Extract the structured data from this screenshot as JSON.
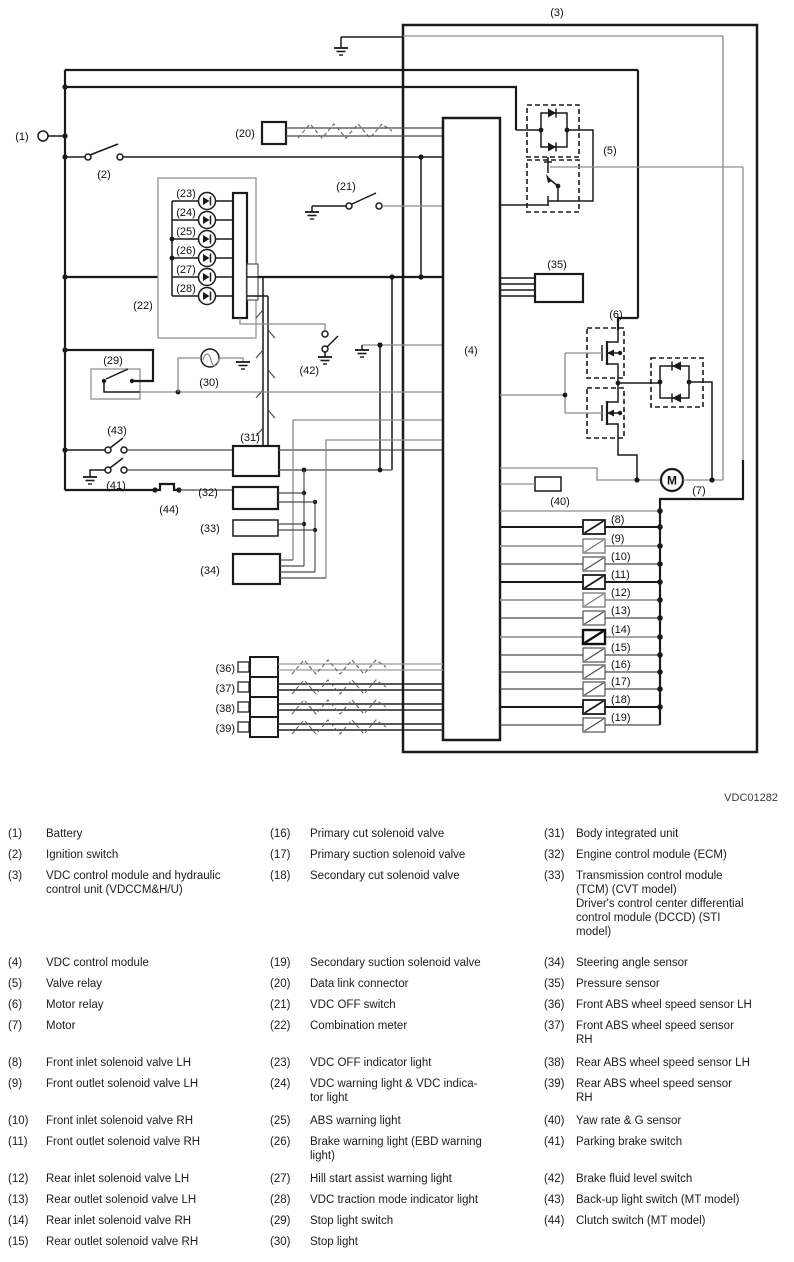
{
  "figure": {
    "code": "VDC01282"
  },
  "colors": {
    "wire": "#1a1a1a",
    "thin": "#4a4a4a",
    "gray": "#8c8c8c",
    "background": "#ffffff"
  },
  "diagram": {
    "callouts": [
      {
        "t": "(1)",
        "x": 22,
        "y": 140
      },
      {
        "t": "(2)",
        "x": 104,
        "y": 178
      },
      {
        "t": "(3)",
        "x": 557,
        "y": 16
      },
      {
        "t": "(4)",
        "x": 471,
        "y": 354
      },
      {
        "t": "(5)",
        "x": 610,
        "y": 154
      },
      {
        "t": "(6)",
        "x": 616,
        "y": 318
      },
      {
        "t": "(7)",
        "x": 699,
        "y": 494
      },
      {
        "t": "(20)",
        "x": 245,
        "y": 137
      },
      {
        "t": "(21)",
        "x": 346,
        "y": 190
      },
      {
        "t": "(22)",
        "x": 143,
        "y": 309
      },
      {
        "t": "(29)",
        "x": 113,
        "y": 364
      },
      {
        "t": "(30)",
        "x": 209,
        "y": 386
      },
      {
        "t": "(31)",
        "x": 250,
        "y": 441
      },
      {
        "t": "(32)",
        "x": 208,
        "y": 496
      },
      {
        "t": "(33)",
        "x": 210,
        "y": 532
      },
      {
        "t": "(34)",
        "x": 210,
        "y": 574
      },
      {
        "t": "(35)",
        "x": 557,
        "y": 268
      },
      {
        "t": "(40)",
        "x": 560,
        "y": 505
      },
      {
        "t": "(41)",
        "x": 116,
        "y": 489
      },
      {
        "t": "(42)",
        "x": 319,
        "y": 374,
        "a": "end"
      },
      {
        "t": "(43)",
        "x": 117,
        "y": 434
      },
      {
        "t": "(44)",
        "x": 169,
        "y": 513
      }
    ],
    "led_rows": {
      "labels": [
        "(23)",
        "(24)",
        "(25)",
        "(26)",
        "(27)",
        "(28)"
      ],
      "ys": [
        201,
        220,
        239,
        258,
        277,
        296
      ]
    },
    "solenoid_rows": {
      "labels": [
        "(8)",
        "(9)",
        "(10)",
        "(11)",
        "(12)",
        "(13)",
        "(14)",
        "(15)",
        "(16)",
        "(17)",
        "(18)",
        "(19)"
      ],
      "ys": [
        527,
        546,
        564,
        582,
        600,
        618,
        637,
        655,
        672,
        689,
        707,
        725
      ],
      "style": [
        "dark",
        "gray",
        "thin",
        "dark",
        "gray",
        "thin",
        "grayDark",
        "thin",
        "thin",
        "thin",
        "dark",
        "thin"
      ]
    },
    "sensor_rows": {
      "labels": [
        "(36)",
        "(37)",
        "(38)",
        "(39)"
      ],
      "ys": [
        664,
        684,
        704,
        724
      ]
    }
  },
  "legend": {
    "bands": [
      {
        "top": 827,
        "cols": [
          [
            {
              "n": "(1)",
              "t": "Battery"
            },
            {
              "n": "(2)",
              "t": "Ignition switch"
            },
            {
              "n": "(3)",
              "t": "VDC control module and hydraulic\ncontrol unit (VDCCM&H/U)"
            }
          ],
          [
            {
              "n": "(16)",
              "t": "Primary cut solenoid valve"
            },
            {
              "n": "(17)",
              "t": "Primary suction solenoid valve"
            },
            {
              "n": "(18)",
              "t": "Secondary cut solenoid valve"
            }
          ],
          [
            {
              "n": "(31)",
              "t": "Body integrated unit"
            },
            {
              "n": "(32)",
              "t": "Engine control module (ECM)"
            },
            {
              "n": "(33)",
              "t": "Transmission control module\n(TCM) (CVT model)\nDriver's control center differential\ncontrol module (DCCD) (STI\nmodel)"
            }
          ]
        ]
      },
      {
        "top": 956,
        "cols": [
          [
            {
              "n": "(4)",
              "t": "VDC control module"
            },
            {
              "n": "(5)",
              "t": "Valve relay"
            },
            {
              "n": "(6)",
              "t": "Motor relay"
            },
            {
              "n": "(7)",
              "t": "Motor"
            }
          ],
          [
            {
              "n": "(19)",
              "t": "Secondary suction solenoid valve"
            },
            {
              "n": "(20)",
              "t": "Data link connector"
            },
            {
              "n": "(21)",
              "t": "VDC OFF switch"
            },
            {
              "n": "(22)",
              "t": "Combination meter"
            }
          ],
          [
            {
              "n": "(34)",
              "t": "Steering angle sensor"
            },
            {
              "n": "(35)",
              "t": "Pressure sensor"
            },
            {
              "n": "(36)",
              "t": "Front ABS wheel speed sensor LH"
            },
            {
              "n": "(37)",
              "t": "Front ABS wheel speed sensor\nRH"
            }
          ]
        ]
      },
      {
        "top": 1056,
        "cols": [
          [
            {
              "n": "(8)",
              "t": "Front inlet solenoid valve LH"
            },
            {
              "n": "(9)",
              "t": "Front outlet solenoid valve LH"
            }
          ],
          [
            {
              "n": "(23)",
              "t": "VDC OFF indicator light"
            },
            {
              "n": "(24)",
              "t": "VDC warning light & VDC indica-\ntor light"
            }
          ],
          [
            {
              "n": "(38)",
              "t": "Rear ABS wheel speed sensor LH"
            },
            {
              "n": "(39)",
              "t": "Rear ABS wheel speed sensor\nRH"
            }
          ]
        ]
      },
      {
        "top": 1114,
        "cols": [
          [
            {
              "n": "(10)",
              "t": "Front inlet solenoid valve RH"
            },
            {
              "n": "(11)",
              "t": "Front outlet solenoid valve RH"
            }
          ],
          [
            {
              "n": "(25)",
              "t": "ABS warning light"
            },
            {
              "n": "(26)",
              "t": "Brake warning light (EBD warning\nlight)"
            }
          ],
          [
            {
              "n": "(40)",
              "t": "Yaw rate & G sensor"
            },
            {
              "n": "(41)",
              "t": "Parking brake switch"
            }
          ]
        ]
      },
      {
        "top": 1172,
        "cols": [
          [
            {
              "n": "(12)",
              "t": "Rear inlet solenoid valve LH"
            },
            {
              "n": "(13)",
              "t": "Rear outlet solenoid valve LH"
            },
            {
              "n": "(14)",
              "t": "Rear inlet solenoid valve RH"
            },
            {
              "n": "(15)",
              "t": "Rear outlet solenoid valve RH"
            }
          ],
          [
            {
              "n": "(27)",
              "t": "Hill start assist warning light"
            },
            {
              "n": "(28)",
              "t": "VDC traction mode indicator light"
            },
            {
              "n": "(29)",
              "t": "Stop light switch"
            },
            {
              "n": "(30)",
              "t": "Stop light"
            }
          ],
          [
            {
              "n": "(42)",
              "t": "Brake fluid level switch"
            },
            {
              "n": "(43)",
              "t": "Back-up light switch (MT model)"
            },
            {
              "n": "(44)",
              "t": "Clutch switch (MT model)"
            }
          ]
        ]
      }
    ]
  }
}
